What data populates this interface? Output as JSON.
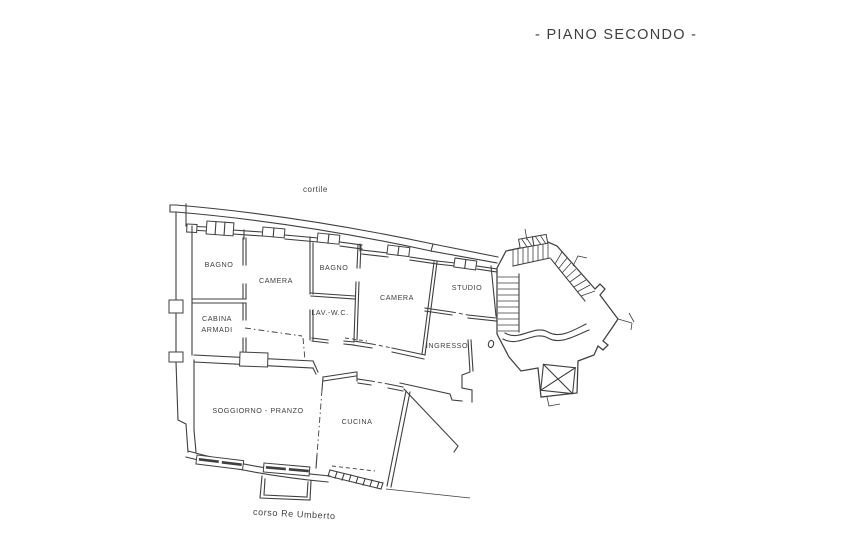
{
  "page": {
    "title": "- PIANO SECONDO -"
  },
  "plan": {
    "type": "floor-plan",
    "courtyard_label": "cortile",
    "street_label": "corso Re Umberto",
    "rooms": {
      "bagno1": "BAGNO",
      "camera1": "CAMERA",
      "bagno2": "BAGNO",
      "lav_wc": "LAV.-W.C.",
      "camera2": "CAMERA",
      "studio": "STUDIO",
      "cabina_line1": "CABINA",
      "cabina_line2": "ARMADI",
      "ingresso": "INGRESSO",
      "soggiorno": "SOGGIORNO - PRANZO",
      "cucina": "CUCINA"
    },
    "features": [
      "staircase",
      "elevator-shaft",
      "balcony",
      "windows"
    ],
    "colors": {
      "ink": "#3f3f3f",
      "paper": "#ffffff"
    }
  }
}
